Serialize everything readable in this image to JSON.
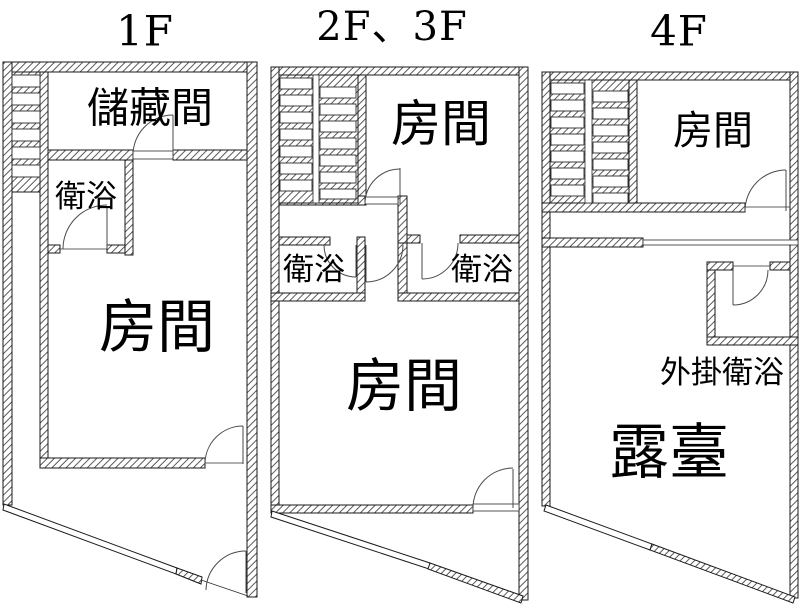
{
  "figure": {
    "background": "#ffffff",
    "line_color": "#1a1a1a",
    "hatch_color": "#5a5a5a",
    "text_color": "#000000"
  },
  "plans": [
    {
      "title": "1F",
      "rooms": {
        "storage": "儲藏間",
        "bath": "衛浴",
        "room": "房間"
      }
    },
    {
      "title": "2F、3F",
      "rooms": {
        "room_top": "房間",
        "bath_left": "衛浴",
        "bath_right": "衛浴",
        "room_main": "房間"
      }
    },
    {
      "title": "4F",
      "rooms": {
        "room": "房間",
        "ext_bath": "外掛衛浴",
        "terrace": "露臺"
      }
    }
  ]
}
